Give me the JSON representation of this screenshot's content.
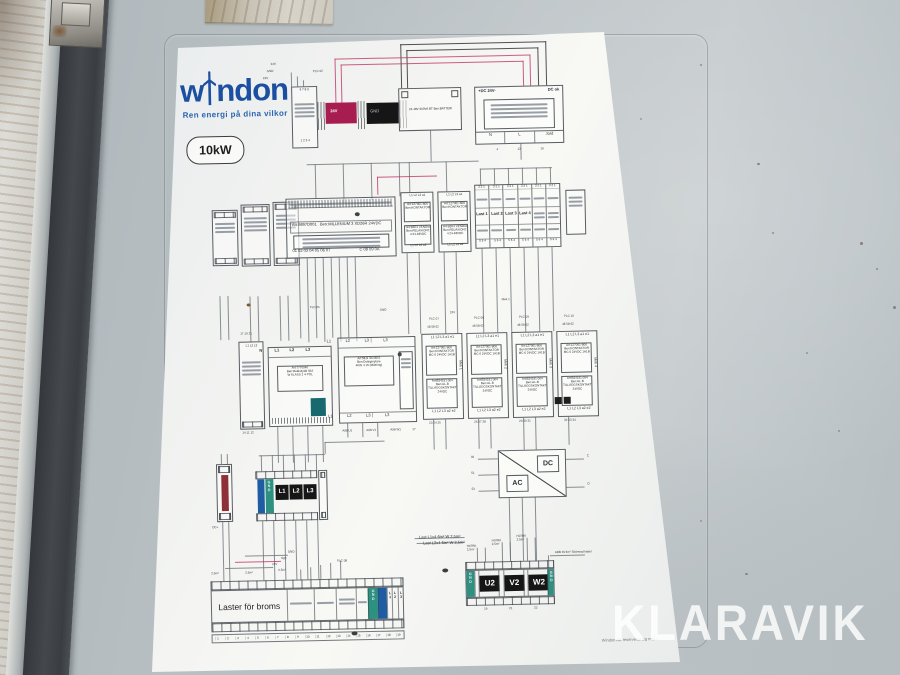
{
  "watermark": "KLARAVIK",
  "brand": {
    "name": "windon",
    "logo_left": "w",
    "logo_right": "ndon",
    "tagline": "Ren energi på dina vilkor",
    "power_badge": "10kW"
  },
  "colors": {
    "logo_blue": "#1b4fa0",
    "crimson": "#a81d4f",
    "teal": "#2d9080",
    "blue_bar": "#1e5ca3",
    "red_bar": "#8e3038",
    "black_box": "#161616",
    "wire_pink": "#c2356b"
  },
  "top": {
    "wire_labels": [
      "24V",
      "GND",
      "24V"
    ],
    "plc02": "PLC 02",
    "relay_pins_top": "6 7 8 9",
    "relay_pins_bottom": "1 2 3 4",
    "box_24v": "24V",
    "box_gnd": "GND",
    "battery": "24-48V 600VA BT  Ben:BATTERI",
    "psu": {
      "header_left": "+DC 24V-",
      "header_right": "DC ok",
      "terminals": [
        "N",
        "L",
        "Jord"
      ],
      "pins": [
        "4",
        "13",
        "16"
      ]
    }
  },
  "plc": {
    "art": "Art:9897D001",
    "ben": "Ben:MILLENIUM 3 XD26R 24VDC",
    "pins_left": "01 02 03 04 05 06 07",
    "pins_right": "C 08 09 0A"
  },
  "upper_k": [
    {
      "header": "L1 L2 L3 a1",
      "box1": [
        "Art:127001 B00",
        "Ben:KONTAKTOR"
      ],
      "box2": [
        "A4 B3K4 VENDIA",
        "Ben:RELÄ/KONT.",
        "4 24-48VDC"
      ],
      "footer": "L1 L2 L3 a2"
    },
    {
      "header": "L1 L2 L3 a1",
      "box1": [
        "Art:127001 B00",
        "Ben:KONTAKTOR"
      ],
      "box2": [
        "A4 B3K4 VENDIA",
        "Ben:RELÄ/KONT.",
        "4 24-48VDC"
      ],
      "footer": "L1 L2 L3 a2"
    }
  ],
  "last": {
    "pins_top": "3 2 1",
    "labels": [
      "Last 1",
      "Last 2",
      "Last 3",
      "Last 4"
    ],
    "pins_bottom": "5 6 4"
  },
  "mid_labels": [
    "PLC 05",
    "GND",
    "24V",
    "Mek 1"
  ],
  "narrow": {
    "pins_top": "17 19 21",
    "header": "L1 L2 L3",
    "pins_bottom": "14 11 12"
  },
  "breaker": {
    "header": [
      "N",
      "L1",
      "L2",
      "L3"
    ],
    "lines": [
      "Art:7770040",
      "Ben:Reläskydd 40A",
      "W KLASS 2 4-POL"
    ]
  },
  "divider": {
    "header": [
      "L1",
      "L2",
      "L3",
      "L3"
    ],
    "lines": [
      "Art:5811 SO BR2",
      "Ben:Dvärgbrytare",
      "4KW 4 16 (Mätning)"
    ],
    "footer": [
      "L1",
      "L2",
      "L3",
      "L3"
    ],
    "sub": [
      "A98 U1",
      "A98 V1",
      "A98 W1"
    ],
    "pin": "17"
  },
  "k": [
    {
      "plc": "PLC 07",
      "pins_top": "48 58 62",
      "header": "L1 L2 L3 a1 e1",
      "box1": [
        "Art:127001 B00",
        "Ben:KONTAKTOR",
        "MC-6 24VDC 1A1B"
      ],
      "box2": [
        "Art:B34191 004",
        "Ben:AL-B",
        "TILLÄGGSKONTAKT",
        "24VDC"
      ],
      "side": "Mek 1",
      "footer": "L1 L2 L3 a2 e2",
      "pins_bottom": "23 24 25"
    },
    {
      "plc": "PLC 08",
      "pins_top": "48 58 62",
      "header": "L1 L2 L3 a1 e1",
      "box1": [
        "Art:127001 B00",
        "Ben:KONTAKTOR",
        "MC-6 24VDC 1A1B"
      ],
      "box2": [
        "Art:B34191 004",
        "Ben:AL-B",
        "TILLÄGGSKONTAKT",
        "24VDC"
      ],
      "side": "Mek 2",
      "footer": "L1 L2 L3 a2 e2",
      "pins_bottom": "26 27 28"
    },
    {
      "plc": "PLC 09",
      "pins_top": "48 58 62",
      "header": "L1 L2 L3 a1 e1",
      "box1": [
        "Art:127001 B00",
        "Ben:KONTAKTOR",
        "MC-6 24VDC 1A1B"
      ],
      "box2": [
        "Art:B34191 004",
        "Ben:AL-B",
        "TILLÄGGSKONTAKT",
        "24VDC"
      ],
      "side": "Mek 3",
      "footer": "L1 L2 L3 a2 e2",
      "pins_bottom": "29 30 31"
    },
    {
      "plc": "PLC 10",
      "pins_top": "48 58 62",
      "header": "L1 L2 L3 a1 e1",
      "box1": [
        "Art:127001 B00",
        "Ben:KONTAKTOR",
        "MC-6 24VDC 1A1B"
      ],
      "box2": [
        "Art:B34191 004",
        "Ben:AL-B",
        "TILLÄGGSKONTAKT",
        "24VDC"
      ],
      "side": "Mek 4",
      "footer": "L1 L2 L3 a2 e2",
      "pins_bottom": "32 33 34"
    }
  ],
  "conv": {
    "dc": "DC",
    "ac": "AC",
    "left": [
      "49",
      "51",
      "53"
    ],
    "right": [
      "C",
      "D"
    ]
  },
  "leftterm": {
    "dc_label": "DC+",
    "gnd": [
      "G",
      "N",
      "D"
    ],
    "phases": [
      "L1",
      "L2",
      "L3"
    ]
  },
  "bottom": {
    "label": "Laster för broms",
    "gnd": [
      "G",
      "N",
      "D"
    ],
    "lcols": [
      [
        "L",
        "1"
      ],
      [
        "L",
        "2"
      ],
      [
        "L",
        "3"
      ]
    ],
    "numbers": [
      "1",
      "2",
      "3",
      "4",
      "5",
      "6",
      "7",
      "8",
      "9",
      "10",
      "11",
      "12",
      "13",
      "14",
      "15",
      "16",
      "17",
      "18",
      "19"
    ],
    "wl": [
      "GND",
      "sign",
      "24V"
    ],
    "sq": [
      "2,5m²",
      "2,5m²",
      "2,5m²"
    ],
    "plc": "PLC 08"
  },
  "motor": {
    "gnd": [
      "G",
      "N",
      "D"
    ],
    "phases": [
      "U2",
      "V2",
      "W2"
    ],
    "pins": [
      "19",
      "21",
      "23"
    ],
    "cables": [
      [
        "H07RK",
        "2,5m²"
      ],
      [
        "H07RK",
        "2,5m²"
      ],
      [
        "H07RK",
        "2,5m²"
      ]
    ],
    "left": [
      "Last L1x4 6m² W 2,5m²",
      "Last L2x4 6m² W 2,5m²"
    ],
    "right": "ABB IN 6m² Skärmad kabel"
  },
  "footer_note": "Windon AB reserverar sig mot ..."
}
